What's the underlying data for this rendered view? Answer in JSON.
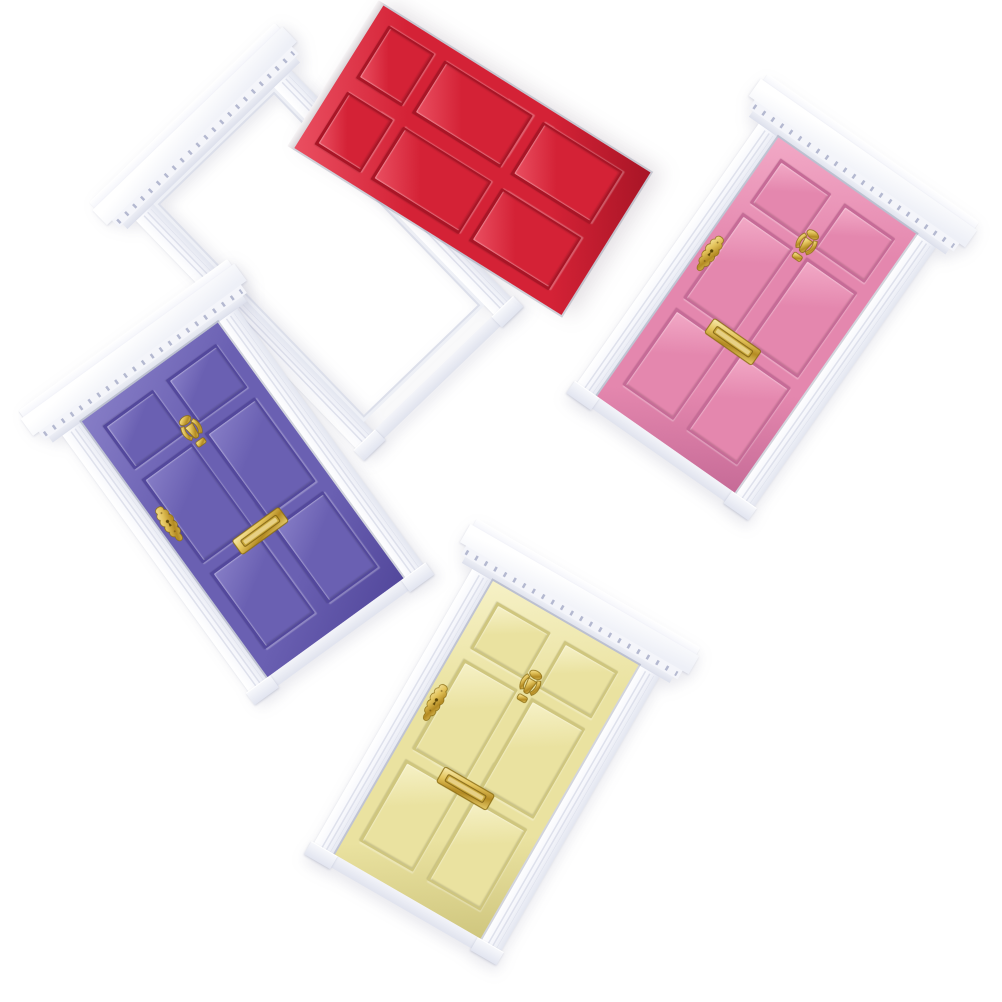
{
  "scene": {
    "description": "Product photo: four miniature dollhouse fairy doors with white wooden frames on a plain white background. A red door leans detached in front of its empty frame at the top left; a pink door sits in its frame at the top right, a purple door at the middle left, and a pale-yellow door at the bottom center. Each frame has a dentil-molded pediment cornice, fluted side jambs and plinth blocks. The pink, purple and yellow doors carry gold-tone hardware; the red door has none.",
    "background_color": "#ffffff",
    "item_count": 4,
    "panels_per_door": 6
  },
  "frame": {
    "label": "white wooden frame with dentil pediment",
    "white": "#f7f8fc",
    "shadow": "#dfe2ec",
    "groove": "#d8dbe8",
    "dentil": "#a9aec9"
  },
  "hardware": {
    "items": [
      "urn knocker",
      "key plate",
      "letter plate"
    ],
    "gold": "#d9b94a",
    "gold_light": "#f9ecb0",
    "gold_dark": "#8a6c12"
  },
  "doors": [
    {
      "id": "red",
      "label": "red door",
      "state": "detached, leaning open in front of its empty frame",
      "colors": {
        "face": "#d42236",
        "shade": "#a81526",
        "highlight": "#ea4f61"
      },
      "hardware": []
    },
    {
      "id": "pink",
      "label": "pink door",
      "state": "mounted in frame",
      "colors": {
        "face": "#e487ae",
        "shade": "#c66globe",
        "highlight": "#f2a9c6"
      },
      "hardware": [
        "key plate",
        "urn knocker",
        "letter plate"
      ]
    },
    {
      "id": "purple",
      "label": "purple door",
      "state": "mounted in frame",
      "colors": {
        "face": "#6a60b2",
        "shade": "#53489c",
        "highlight": "#867dc6"
      },
      "hardware": [
        "urn knocker",
        "key plate",
        "letter plate"
      ]
    },
    {
      "id": "yellow",
      "label": "pale yellow door",
      "state": "mounted in frame",
      "colors": {
        "face": "#eae2a0",
        "shade": "#cfc67e",
        "highlight": "#f6f1c6"
      },
      "hardware": [
        "key plate",
        "urn knocker",
        "letter plate"
      ]
    }
  ]
}
